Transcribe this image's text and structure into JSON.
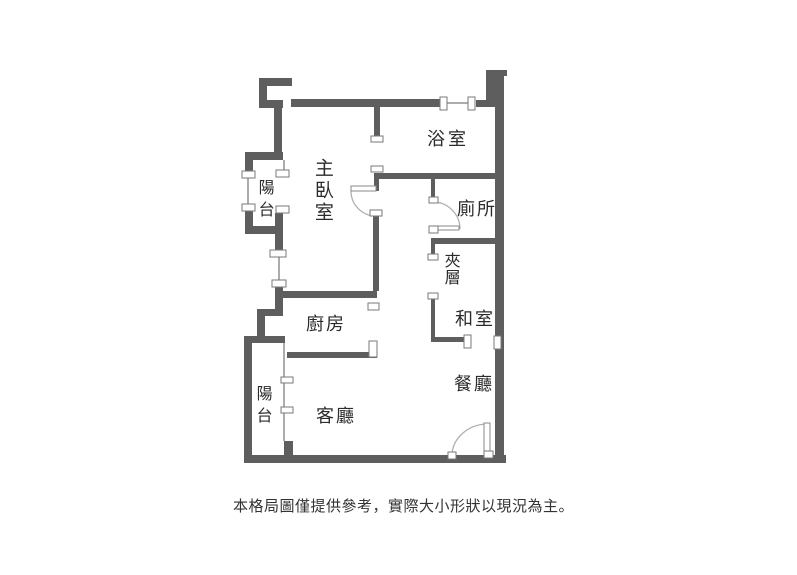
{
  "caption": {
    "text": "本格局圖僅提供參考，實際大小形狀以現況為主。"
  },
  "rooms": {
    "master_bedroom": {
      "label": "主臥室"
    },
    "bathroom": {
      "label": "浴室"
    },
    "toilet": {
      "label": "廁所"
    },
    "mezzanine": {
      "label": "夾層"
    },
    "tatami_room": {
      "label": "和室"
    },
    "kitchen": {
      "label": "廚房"
    },
    "dining_room": {
      "label": "餐廳"
    },
    "living_room": {
      "label": "客廳"
    },
    "balcony_upper": {
      "label": "陽台"
    },
    "balcony_lower": {
      "label": "陽台"
    }
  },
  "colors": {
    "wall": "#5e5e5e",
    "thin_line": "#909090",
    "cap_fill": "#ffffff",
    "cap_border": "#7a7a7a",
    "door_arc": "#b0b0b0",
    "door_leaf_border": "#8a8a8a",
    "label_text": "#2b2b2b",
    "caption_text": "#333333"
  },
  "floorplan": {
    "canvas": {
      "width": 797,
      "height": 575
    },
    "walls": [
      [
        259,
        78,
        33,
        8
      ],
      [
        259,
        78,
        8,
        30
      ],
      [
        259,
        100,
        24,
        8
      ],
      [
        274,
        100,
        8,
        56
      ],
      [
        245,
        152,
        38,
        8
      ],
      [
        245,
        158,
        8,
        17
      ],
      [
        245,
        208,
        8,
        26
      ],
      [
        245,
        226,
        38,
        8
      ],
      [
        275,
        213,
        8,
        38
      ],
      [
        275,
        287,
        8,
        29
      ],
      [
        257,
        309,
        26,
        7
      ],
      [
        257,
        309,
        8,
        28
      ],
      [
        244,
        336,
        41,
        7
      ],
      [
        244,
        336,
        8,
        127
      ],
      [
        244,
        455,
        262,
        8
      ],
      [
        284,
        441,
        9,
        15
      ],
      [
        287,
        352,
        90,
        6
      ],
      [
        280,
        291,
        97,
        7
      ],
      [
        373,
        215,
        6,
        76
      ],
      [
        291,
        99,
        152,
        8
      ],
      [
        476,
        100,
        14,
        7
      ],
      [
        486,
        70,
        9,
        37
      ],
      [
        486,
        70,
        21,
        6
      ],
      [
        495,
        70,
        9,
        393
      ],
      [
        377,
        173,
        118,
        6
      ],
      [
        374,
        107,
        6,
        30
      ],
      [
        374,
        173,
        5,
        18
      ],
      [
        431,
        238,
        64,
        6
      ],
      [
        431,
        179,
        4,
        19
      ],
      [
        431,
        244,
        4,
        12
      ],
      [
        431,
        297,
        4,
        43
      ],
      [
        431,
        337,
        37,
        5
      ]
    ],
    "thin_lines": [
      [
        248,
        177,
        248,
        204
      ],
      [
        284,
        160,
        284,
        171
      ],
      [
        279,
        257,
        279,
        280
      ],
      [
        284,
        343,
        284,
        441
      ],
      [
        447,
        103,
        470,
        103
      ]
    ],
    "caps": [
      [
        242,
        171,
        13,
        7
      ],
      [
        242,
        204,
        13,
        7
      ],
      [
        276,
        170,
        13,
        7
      ],
      [
        276,
        206,
        13,
        7
      ],
      [
        270,
        250,
        16,
        7
      ],
      [
        272,
        280,
        14,
        7
      ],
      [
        368,
        303,
        11,
        7
      ],
      [
        369,
        341,
        8,
        16
      ],
      [
        281,
        377,
        12,
        6
      ],
      [
        281,
        407,
        12,
        6
      ],
      [
        440,
        97,
        7,
        13
      ],
      [
        468,
        97,
        7,
        13
      ],
      [
        371,
        136,
        12,
        6
      ],
      [
        371,
        166,
        12,
        6
      ],
      [
        370,
        210,
        12,
        6
      ],
      [
        429,
        197,
        9,
        6
      ],
      [
        429,
        226,
        9,
        7
      ],
      [
        428,
        254,
        10,
        6
      ],
      [
        428,
        293,
        10,
        6
      ],
      [
        464,
        335,
        7,
        13
      ],
      [
        494,
        336,
        7,
        13
      ],
      [
        448,
        452,
        8,
        7
      ],
      [
        484,
        451,
        9,
        7
      ]
    ],
    "door_leaves": [
      [
        351,
        186,
        25,
        5
      ],
      [
        484,
        423,
        6,
        33
      ],
      [
        433,
        226,
        26,
        4
      ]
    ],
    "door_arcs": [
      "M351,191 A25,25 0 0 0 376,216",
      "M433,202 A27,27 0 0 1 460,229",
      "M452,456 A36,32 0 0 1 488,424"
    ]
  }
}
